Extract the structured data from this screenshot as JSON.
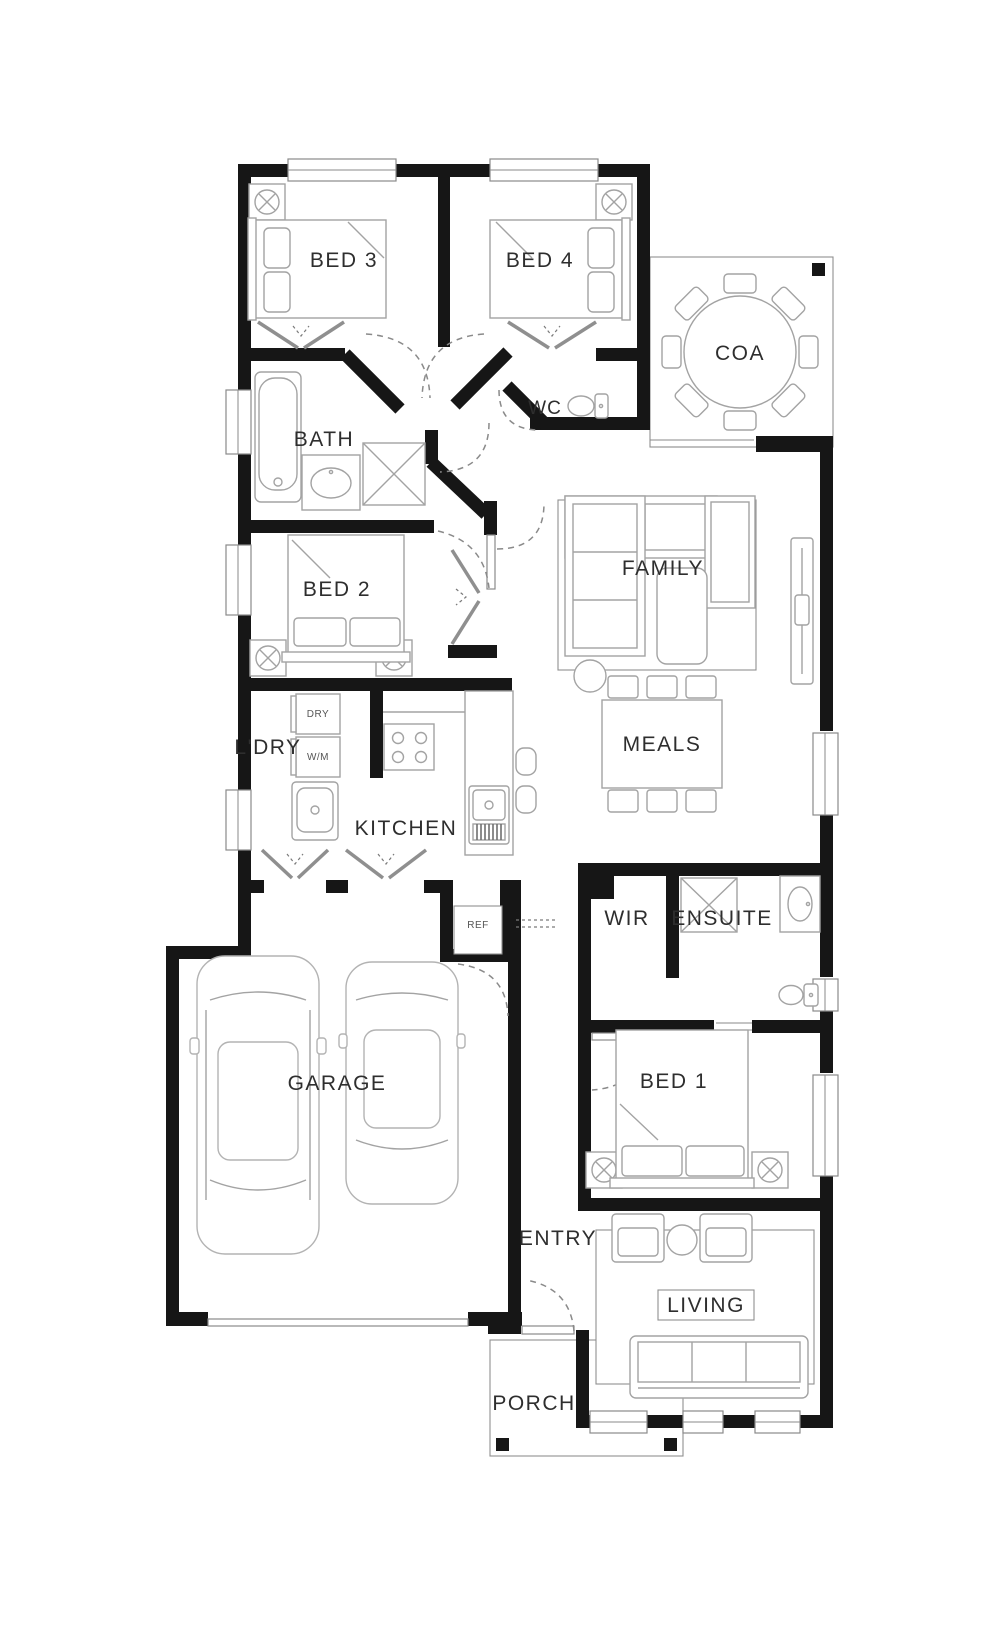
{
  "plan": {
    "type": "residential-floor-plan",
    "rooms": {
      "bed3": "BED 3",
      "bed4": "BED 4",
      "coa": "COA",
      "wc": "WC",
      "bath": "BATH",
      "family": "FAMILY",
      "bed2": "BED 2",
      "meals": "MEALS",
      "ldry": "L'DRY",
      "kitchen": "KITCHEN",
      "wir": "WIR",
      "ensuite": "ENSUITE",
      "garage": "GARAGE",
      "bed1": "BED 1",
      "entry": "ENTRY",
      "living": "LIVING",
      "porch": "PORCH"
    },
    "appliances": {
      "dryer": "DRY",
      "washer": "W/M",
      "fridge": "REF"
    },
    "colors": {
      "wall": "#161616",
      "furniture_line": "#a3a3a3",
      "text": "#2e2e2e",
      "background": "#ffffff"
    }
  }
}
